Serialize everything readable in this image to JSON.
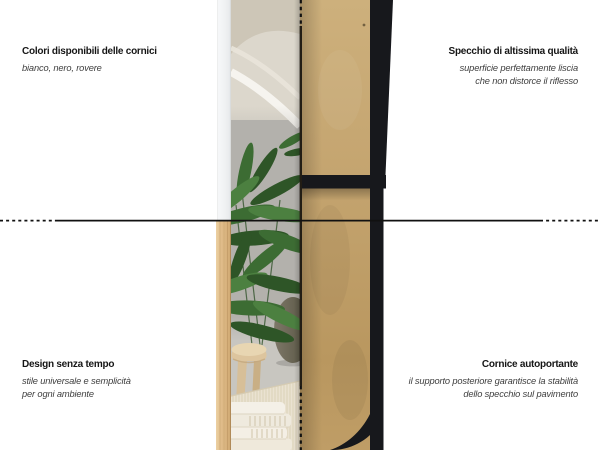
{
  "annotations": {
    "top_left": {
      "title": "Colori disponibili delle cornici",
      "lines": [
        "bianco, nero, rovere"
      ]
    },
    "top_right": {
      "title": "Specchio di altissima qualità",
      "lines": [
        "superficie perfettamente liscia",
        "che non distorce il riflesso"
      ]
    },
    "bottom_left": {
      "title": "Design senza tempo",
      "lines": [
        "stile universale e semplicità",
        "per ogni ambiente"
      ]
    },
    "bottom_right": {
      "title": "Cornice autoportante",
      "lines": [
        "il supporto posteriore garantisce la stabilità",
        "dello specchio sul pavimento"
      ]
    }
  },
  "colors": {
    "background": "#ffffff",
    "text_title": "#161616",
    "text_subtitle": "#3f3f3f",
    "guide_line": "#111111",
    "frame_black": "#17181c",
    "frame_white": "#f0f2f3",
    "frame_oak": "#e0bd8a",
    "mdf_panel": "#c2a26c",
    "mirror_wall": "#b3b1ac",
    "plant_green": "#3c6c33",
    "rug_cream": "#eae2d1"
  }
}
